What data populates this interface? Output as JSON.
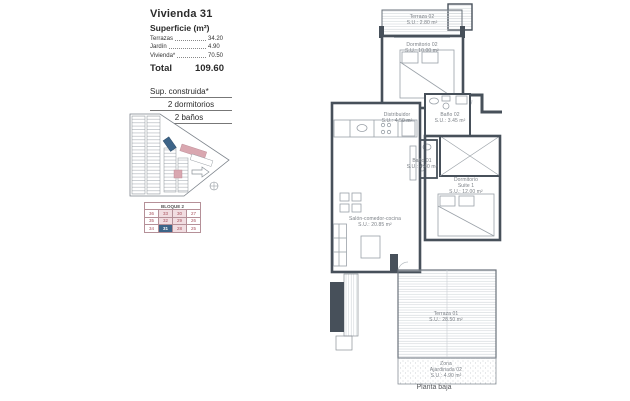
{
  "doc": {
    "title": "Vivienda 31",
    "subtitle": "Superficie (m²)",
    "surface_rows": [
      {
        "label": "Terrazas",
        "value": "34.20"
      },
      {
        "label": "Jardín",
        "value": "4.90"
      },
      {
        "label": "Vivienda*",
        "value": "70.50"
      }
    ],
    "total_label": "Total",
    "total_value": "109.60",
    "built_lines": [
      "Sup. construida*",
      "2 dormitorios",
      "2 baños"
    ]
  },
  "block_table": {
    "title": "BLOQUE 2",
    "rows": [
      [
        "36",
        "33",
        "30",
        "27"
      ],
      [
        "35",
        "32",
        "29",
        "26"
      ],
      [
        "34",
        "31",
        "28",
        "25"
      ]
    ],
    "selected_unit": "31"
  },
  "plan": {
    "rooms": {
      "terraza02": {
        "name": "Terraza 02",
        "area": "S.U.: 2.80 m²"
      },
      "dormitorio02": {
        "name": "Dormitorio 02",
        "area": "S.U.: 10.00 m²"
      },
      "distribuidor": {
        "name": "Distribuidor",
        "area": "S.U.: 4.50 m²"
      },
      "bano02": {
        "name": "Baño 02",
        "area": "S.U.: 3.45 m²"
      },
      "bano01": {
        "name": "Baño 01",
        "area": "S.U.: 4.40 m²"
      },
      "suite": {
        "name": "Dormitorio",
        "name2": "Suite 1",
        "area": "S.U.: 12.00 m²"
      },
      "salon": {
        "name": "Salón-comedor-cocina",
        "area": "S.U.: 20.85 m²"
      },
      "terraza01": {
        "name": "Terraza 01",
        "area": "S.U.: 28.50 m²"
      },
      "zona": {
        "name": "Zona",
        "name2": "Ajardinada 02",
        "area": "S.U.: 4.90 m²"
      }
    },
    "caption": "Planta baja"
  },
  "colors": {
    "wall": "#47505a",
    "thin_line": "#9aa1a8",
    "selected_blue": "#3d6488",
    "highlight_pink": "#d9a7b0",
    "number_red": "#a8505c"
  }
}
